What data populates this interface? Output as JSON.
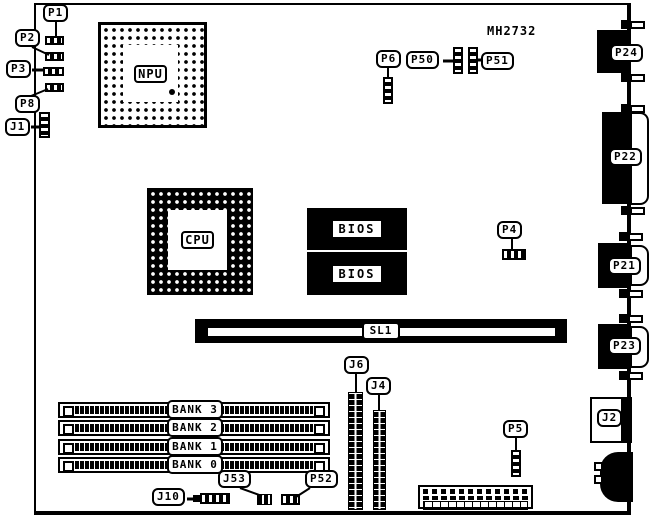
{
  "model": "MH2732",
  "chips": {
    "npu": "NPU",
    "cpu": "CPU",
    "bios_top": "BIOS",
    "bios_bottom": "BIOS"
  },
  "slot_sl1": "SL1",
  "memory_banks": [
    {
      "label": "BANK 3"
    },
    {
      "label": "BANK 2"
    },
    {
      "label": "BANK 1"
    },
    {
      "label": "BANK 0"
    }
  ],
  "connectors": {
    "p1": "P1",
    "p2": "P2",
    "p3": "P3",
    "p8": "P8",
    "j1": "J1",
    "p6": "P6",
    "p50": "P50",
    "p51": "P51",
    "p4": "P4",
    "p5": "P5",
    "j6": "J6",
    "j4": "J4",
    "j10": "J10",
    "j53": "J53",
    "p52": "P52",
    "p24": "P24",
    "p22": "P22",
    "p21": "P21",
    "p23": "P23",
    "j2": "J2"
  }
}
